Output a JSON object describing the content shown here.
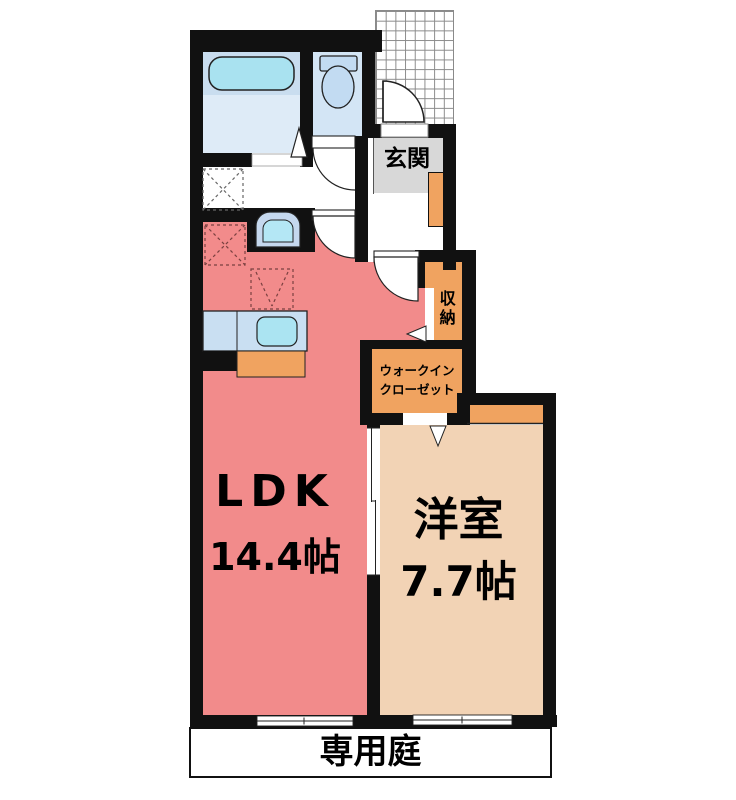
{
  "page": {
    "type": "apartment-floor-plan"
  },
  "rooms": {
    "ldk": {
      "label": "LDK",
      "size": "14.4帖"
    },
    "western_room": {
      "label": "洋室",
      "size": "7.7帖"
    },
    "entrance": {
      "label": "玄関"
    },
    "storage": {
      "label": "収納"
    },
    "walk_in_closet": {
      "label": "ウォークイン\nクローゼット"
    },
    "private_garden": {
      "label": "専用庭"
    }
  },
  "colors": {
    "ldk_floor": "#F28B8B",
    "western_room_floor": "#F2D3B5",
    "closet_orange": "#F0A360",
    "entrance_floor_gray": "#D8D8D8",
    "bathroom_floor": "#DEEBF7",
    "bathtub_zone": "#C9DDEF",
    "bathtub_fill": "#A9E2F0",
    "toilet_floor": "#D3E5F5",
    "fixture_blue": "#C2DBF2",
    "washbasin_outer": "#C5D8EE",
    "sink_cyan": "#ABE4F2",
    "wall": "#111111"
  },
  "icons": {
    "bathtub": "bathtub-icon",
    "toilet": "toilet-icon",
    "washbasin": "washbasin-icon",
    "kitchen_sink": "kitchen-sink-icon",
    "washing_machine_space": "washing-machine-space-icon",
    "refrigerator_space": "refrigerator-space-icon"
  }
}
